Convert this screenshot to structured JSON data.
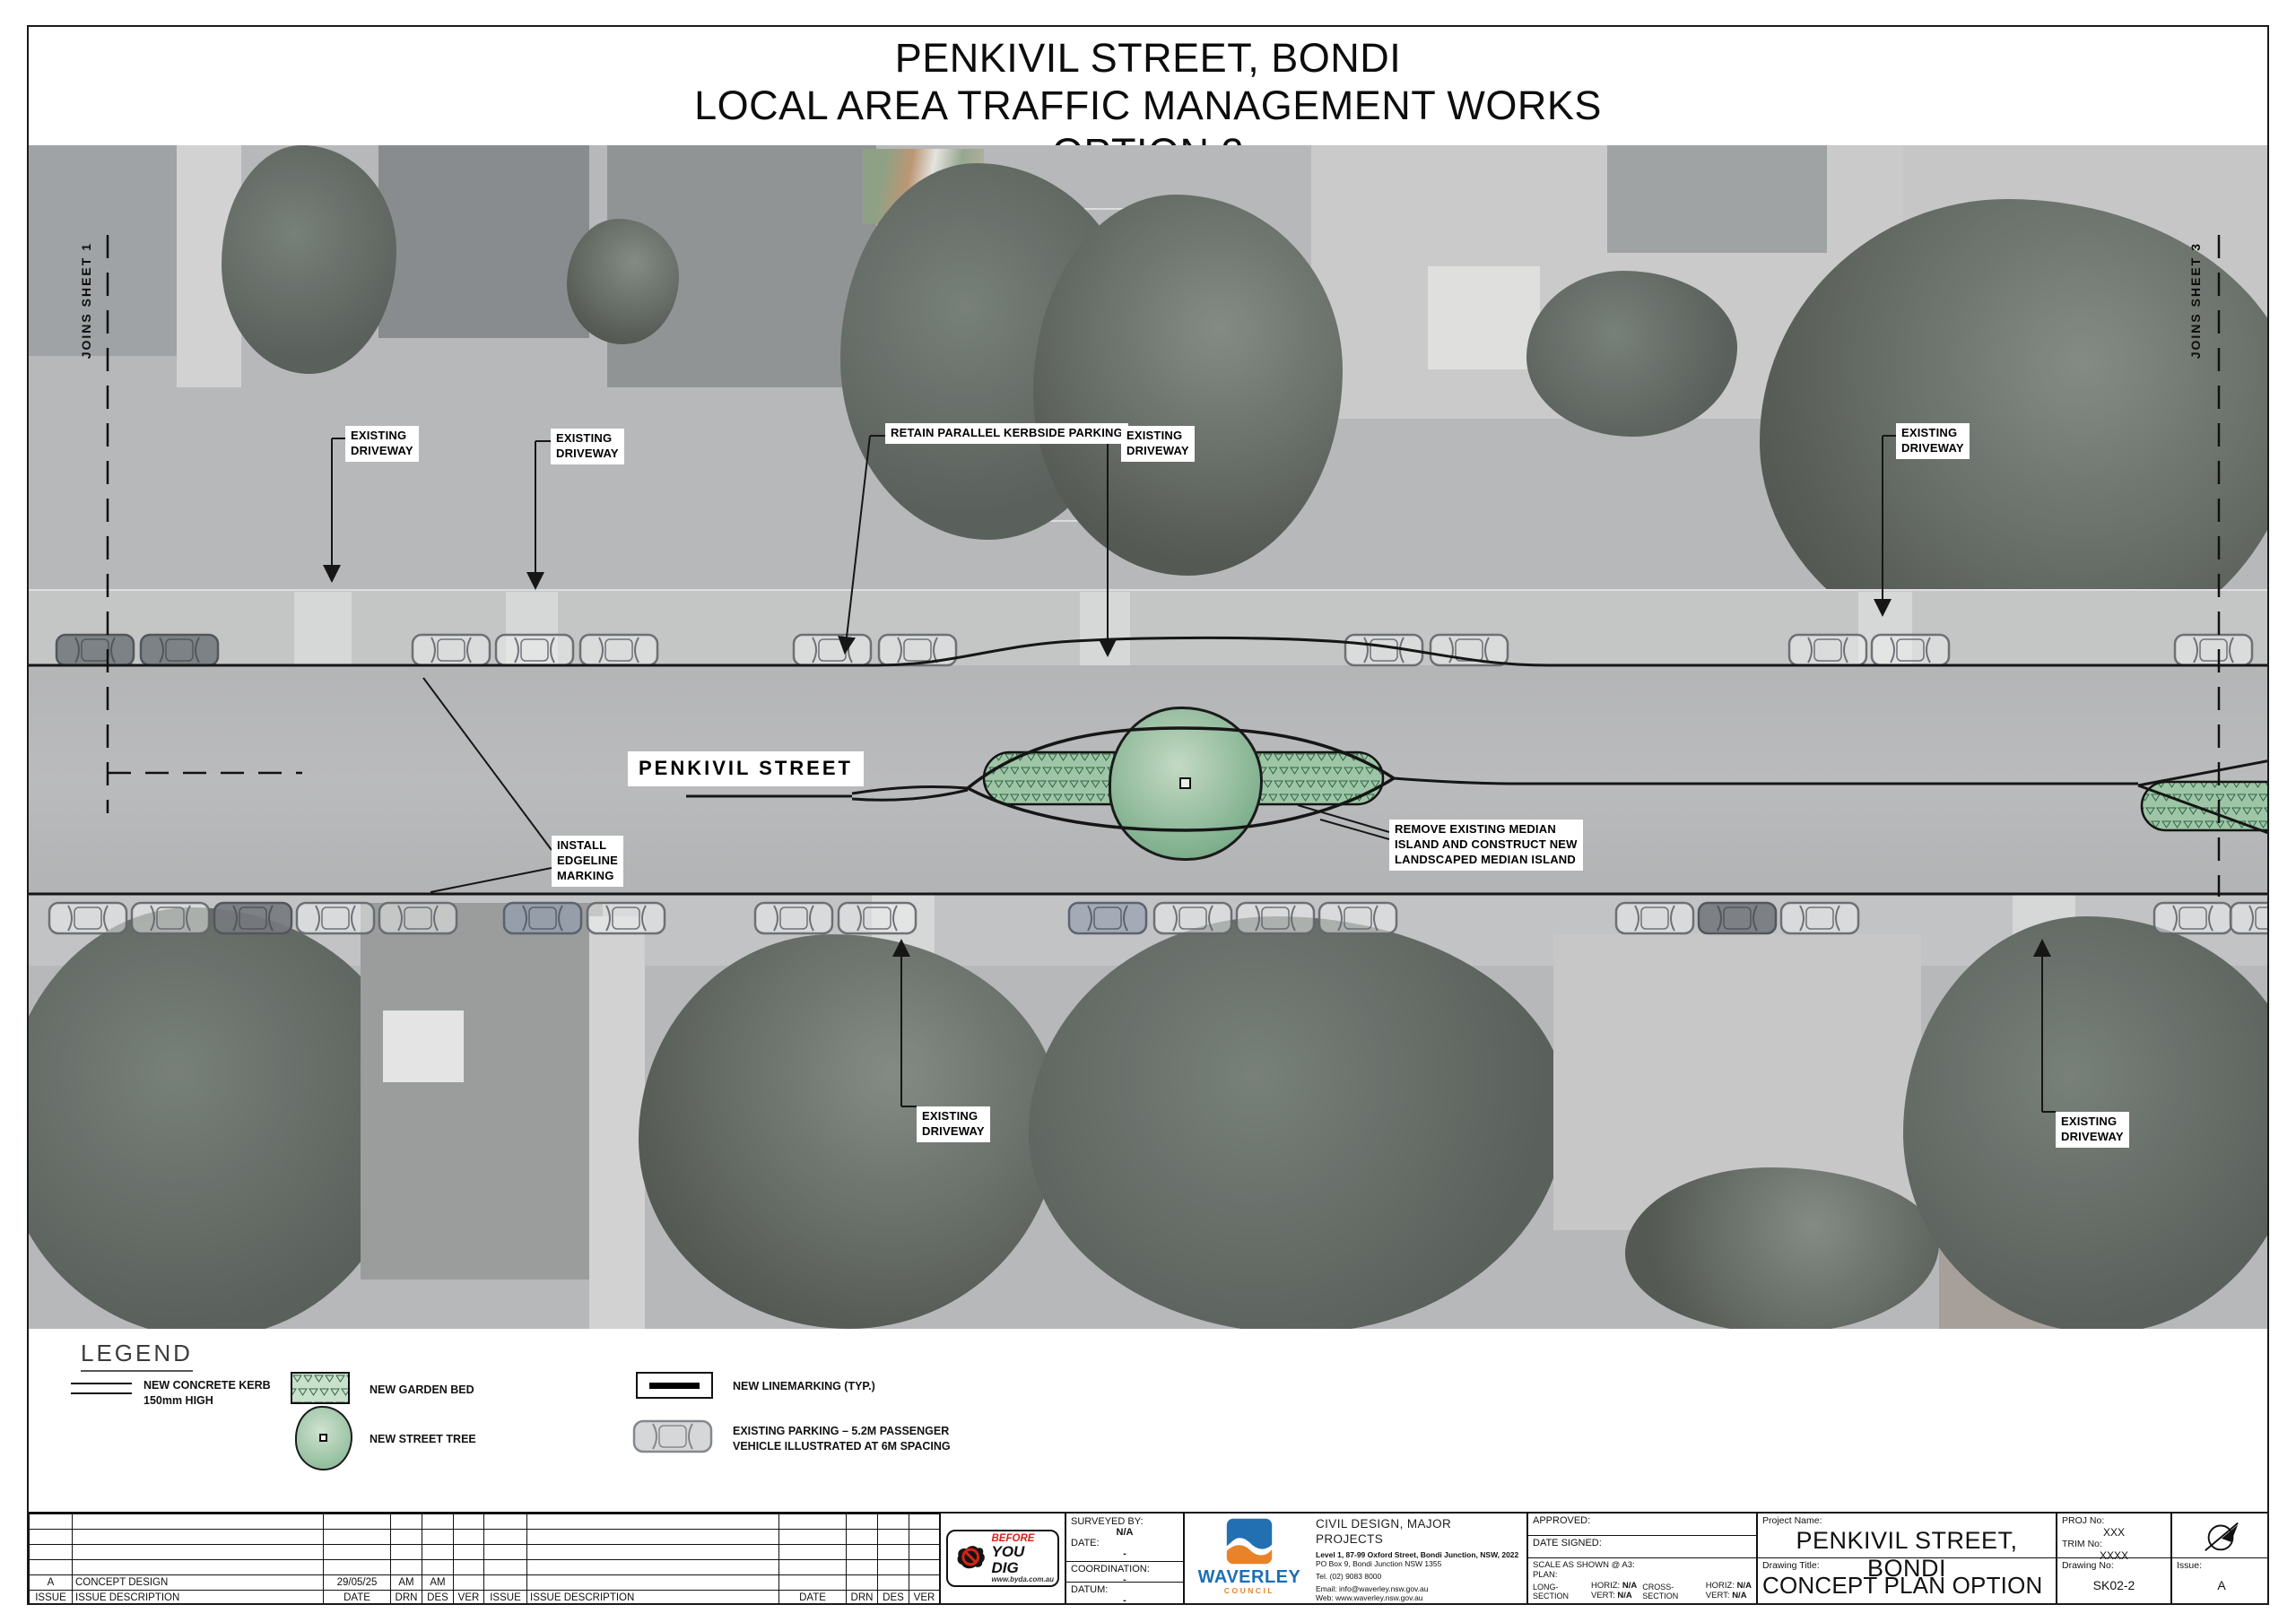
{
  "title": {
    "line1": "PENKIVIL STREET, BONDI",
    "line2": "LOCAL AREA TRAFFIC MANAGEMENT WORKS",
    "line3": "OPTION 2"
  },
  "plan": {
    "street_label": "PENKIVIL STREET",
    "joins_left": "JOINS SHEET 1",
    "joins_right": "JOINS SHEET 3",
    "callouts": {
      "existing_driveway": "EXISTING\nDRIVEWAY",
      "retain_parking": "RETAIN PARALLEL KERBSIDE PARKING",
      "install_edgeline": "INSTALL\nEDGELINE\nMARKING",
      "remove_median": "REMOVE EXISTING MEDIAN\nISLAND AND CONSTRUCT NEW\nLANDSCAPED MEDIAN ISLAND"
    }
  },
  "legend": {
    "title": "LEGEND",
    "kerb": "NEW CONCRETE KERB\n150mm HIGH",
    "garden_bed": "NEW GARDEN BED",
    "street_tree": "NEW STREET TREE",
    "linemarking": "NEW LINEMARKING (TYP.)",
    "parking": "EXISTING PARKING – 5.2M PASSENGER\nVEHICLE ILLUSTRATED AT 6M SPACING"
  },
  "issue_table": {
    "headers": [
      "ISSUE",
      "ISSUE DESCRIPTION",
      "DATE",
      "DRN",
      "DES",
      "VER"
    ],
    "row_a": {
      "issue": "A",
      "description": "CONCEPT DESIGN",
      "date": "29/05/25",
      "drn": "AM",
      "des": "AM",
      "ver": ""
    }
  },
  "before_you_dig": {
    "line1": "BEFORE",
    "line2": "YOU DIG",
    "url": "www.byda.com.au"
  },
  "survey": {
    "surveyed_by_label": "SURVEYED BY:",
    "surveyed_by": "N/A",
    "date_label": "DATE:",
    "date": "-",
    "coordination_label": "COORDINATION:",
    "coordination": "-",
    "datum_label": "DATUM:",
    "datum": "-"
  },
  "council": {
    "logo_name": "WAVERLEY",
    "logo_sub": "COUNCIL",
    "department": "CIVIL DESIGN, MAJOR PROJECTS",
    "address1": "Level 1, 87-99 Oxford Street, Bondi Junction, NSW, 2022",
    "address2": "PO Box 9, Bondi Junction NSW 1355",
    "tel": "Tel. (02) 9083 8000",
    "email": "Email: info@waverley.nsw.gov.au",
    "web": "Web: www.waverley.nsw.gov.au"
  },
  "approval": {
    "approved_label": "APPROVED:",
    "date_signed_label": "DATE SIGNED:",
    "scale_label": "SCALE AS SHOWN @ A3:",
    "plan_label": "PLAN:",
    "long_section_label": "LONG-SECTION",
    "cross_section_label": "CROSS-SECTION",
    "horiz_label": "HORIZ:",
    "vert_label": "VERT:",
    "long_horiz": "N/A",
    "long_vert": "N/A",
    "cross_horiz": "N/A",
    "cross_vert": "N/A"
  },
  "project": {
    "name_label": "Project Name:",
    "name": "PENKIVIL STREET, BONDI",
    "proj_no_label": "PROJ No:",
    "proj_no": "XXX",
    "trim_no_label": "TRIM No:",
    "trim_no": "XXXX",
    "drawing_title_label": "Drawing Title:",
    "drawing_title": "CONCEPT PLAN OPTION 2 - SHEET 2",
    "drawing_no_label": "Drawing No:",
    "drawing_no": "SK02-2",
    "issue_label": "Issue:",
    "issue": "A"
  },
  "colors": {
    "waverley_blue": "#1b6fb5",
    "waverley_orange": "#e8832a",
    "byd_red": "#d42315",
    "garden_bed_green": "#9ec6a6",
    "tree_green": "#8fb89a"
  }
}
